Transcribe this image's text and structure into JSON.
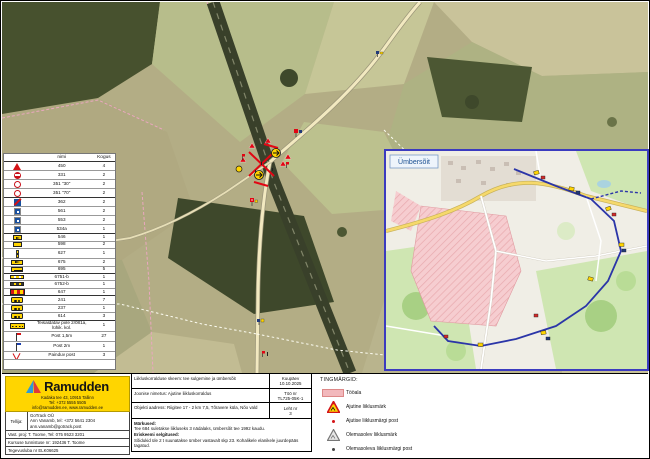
{
  "legend_table": {
    "header_name": "nimi",
    "header_qty": "Kogus",
    "rows": [
      {
        "icon": "roadworks-triangle",
        "name": "450",
        "qty": "4"
      },
      {
        "icon": "no-entry",
        "name": "331",
        "qty": "2"
      },
      {
        "icon": "speed-ring",
        "name": "351 \"30\"",
        "qty": "2"
      },
      {
        "icon": "speed-ring",
        "name": "351 \"70\"",
        "qty": "2"
      },
      {
        "icon": "blue-red-sign",
        "name": "362",
        "qty": "2"
      },
      {
        "icon": "blue-sign",
        "name": "561",
        "qty": "2"
      },
      {
        "icon": "blue-sign",
        "name": "553",
        "qty": "2"
      },
      {
        "icon": "blue-sign",
        "name": "534a",
        "qty": "1"
      },
      {
        "icon": "yellow-arrow-plate",
        "name": "546",
        "qty": "1"
      },
      {
        "icon": "yellow-plate",
        "name": "598",
        "qty": "2"
      },
      {
        "icon": "delineator-post",
        "name": "627",
        "qty": "1"
      },
      {
        "icon": "arrow-board",
        "name": "675",
        "qty": "2"
      },
      {
        "icon": "yellow-text-plate",
        "name": "695",
        "qty": "5"
      },
      {
        "icon": "barrier-plank",
        "name": "6751-b",
        "qty": "1"
      },
      {
        "icon": "barrier-plank-dark",
        "name": "6752-b",
        "qty": "1"
      },
      {
        "icon": "striped-barrier",
        "name": "647",
        "qty": "1"
      },
      {
        "icon": "warning-lamps",
        "name": "241",
        "qty": "7"
      },
      {
        "icon": "warning-lamps",
        "name": "237",
        "qty": "1"
      },
      {
        "icon": "warning-lamps",
        "name": "614",
        "qty": "3"
      },
      {
        "icon": "portable-fence",
        "name": "Teisaldatav piire 2/081a, lühik. kol.",
        "qty": "1"
      },
      {
        "icon": "flag-red",
        "name": "Post 1,5m",
        "qty": "27"
      },
      {
        "icon": "flag-blue",
        "name": "Post 2m",
        "qty": "1"
      },
      {
        "icon": "flex-post",
        "name": "Painduv post",
        "qty": "3"
      }
    ]
  },
  "inset": {
    "label": "Ümbersõit"
  },
  "info_box": {
    "row1_left": "Liikluskorralduse skeem: tee sulgemine ja ümbersõit",
    "row1_right_label": "Kuupäev",
    "row1_right_value": "10.10.2025",
    "row2_left": "Joonise nimetus: Ajutine liikluskorraldus",
    "row2_right_label": "Töö nr",
    "row2_right_value": "TL725-05K-1",
    "row3_left": "Objekti aadress: Riigitee 17 - 2 km 7,5, Tõravere küla, Nõo vald",
    "row3_right_label": "Leht nr",
    "row3_right_value": "3",
    "notes_title": "Märkused:",
    "note1": "Tee 684 suletakse liikluseks 3 nädalaks, ümbersõit tee 1992 kaudu.",
    "notes_subtitle": "Eriskeemi selgitused:",
    "note2": "Sõidukid üle 2 t suunatakse ümber vastavalt skp 23. Kohalikele elanikele juurdepääs tagatud."
  },
  "company": {
    "name": "Ramudden",
    "address_line1": "Kadaka tee 43, 10915 Tallinn",
    "address_line2": "Tel: +372 5555 5505",
    "address_line3": "info@ramudden.ee, www.ramudden.ee",
    "client_label": "Tellija:",
    "client_line1": "GoTrack OÜ",
    "client_line2": "Ann Vanamb, tel: +372 5641 2304",
    "client_line3": "ann.vanamb@gotrack.post",
    "prepared_line": "Vast. proj: T. Toome, Tel: 075 9523 3201",
    "course_line": "Kursuse tunnistuse nr: 192436 T. Toome",
    "license_line": "Tegevusluba nr ELK06625"
  },
  "symbols": {
    "title": "TINGMÄRGID:",
    "items": [
      {
        "icon": "work-area",
        "label": "Tööala"
      },
      {
        "icon": "temp-sign-triangle",
        "label": "Ajutine liiklusmärk"
      },
      {
        "icon": "temp-sign-post",
        "label": "Ajutise liiklusmärgi post"
      },
      {
        "icon": "existing-sign-triangle",
        "label": "Olemasolev liiklusmärk"
      },
      {
        "icon": "existing-sign-post",
        "label": "Olemasoleva liiklusmärgi post"
      }
    ]
  },
  "colors": {
    "brand_yellow": "#ffd500",
    "work_area_pink": "#f2b8bc",
    "route_blue": "#2b35a8",
    "inset_border": "#3b3bbf",
    "marker_red": "#d41317",
    "marker_yellow": "#ffd400"
  }
}
